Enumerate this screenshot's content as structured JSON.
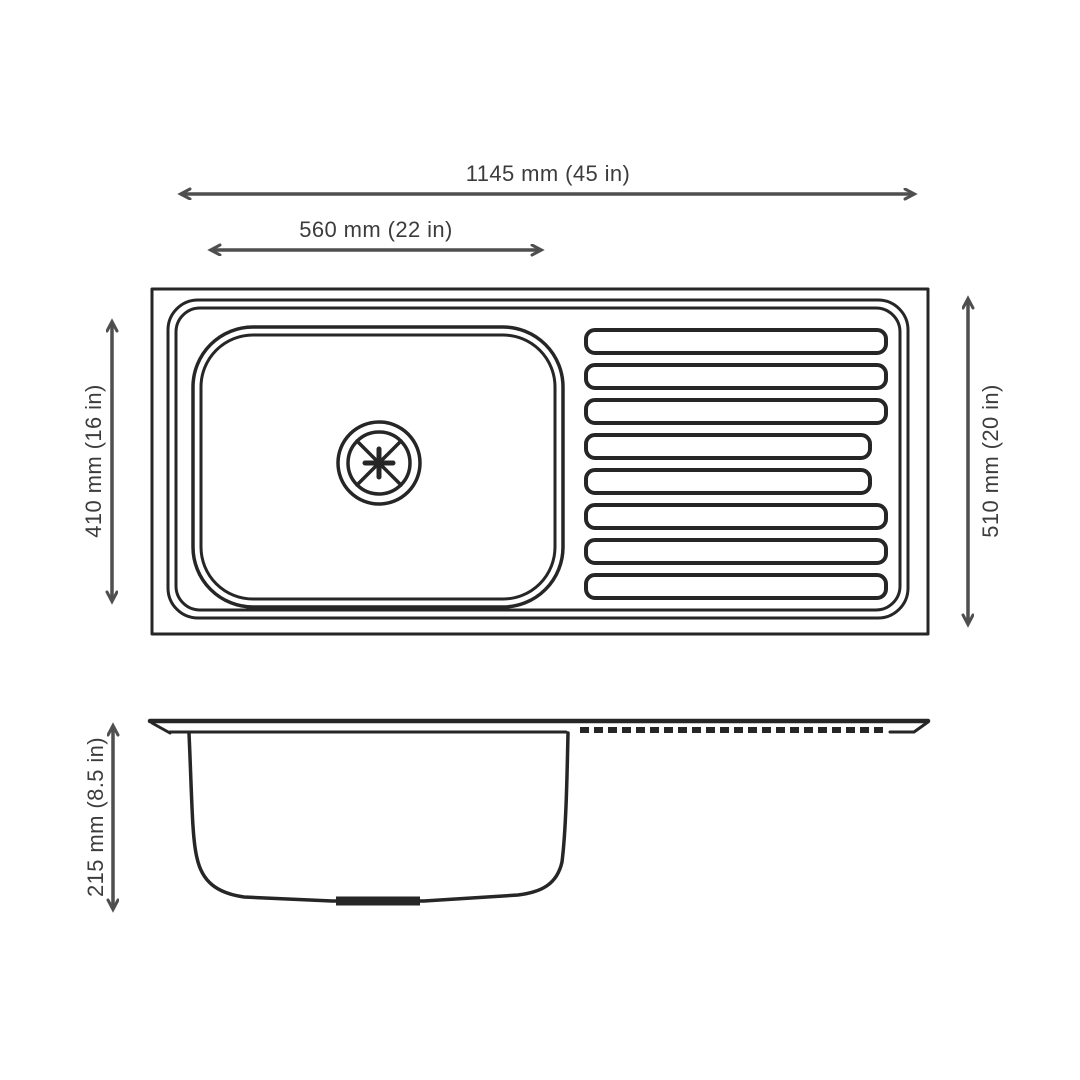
{
  "colors": {
    "outline": "#262626",
    "dimension_line": "#4f4f4f",
    "label_text": "#3c3c3c",
    "background": "#ffffff"
  },
  "dimensions": {
    "overall_width": {
      "label": "1145 mm (45 in)",
      "value_mm": 1145,
      "value_in": 45
    },
    "bowl_width": {
      "label": "560 mm (22 in)",
      "value_mm": 560,
      "value_in": 22
    },
    "bowl_front_to_back": {
      "label": "410 mm (16 in)",
      "value_mm": 410,
      "value_in": 16
    },
    "overall_front_to_back": {
      "label": "510 mm (20 in)",
      "value_mm": 510,
      "value_in": 20
    },
    "bowl_depth": {
      "label": "215 mm (8.5 in)",
      "value_mm": 215,
      "value_in": 8.5
    }
  },
  "drawing": {
    "subject": "single-bowl kitchen sink with drainboard, dimensioned technical drawing",
    "views": [
      "top view",
      "side profile view"
    ],
    "drainboard_slat_count": 8
  }
}
